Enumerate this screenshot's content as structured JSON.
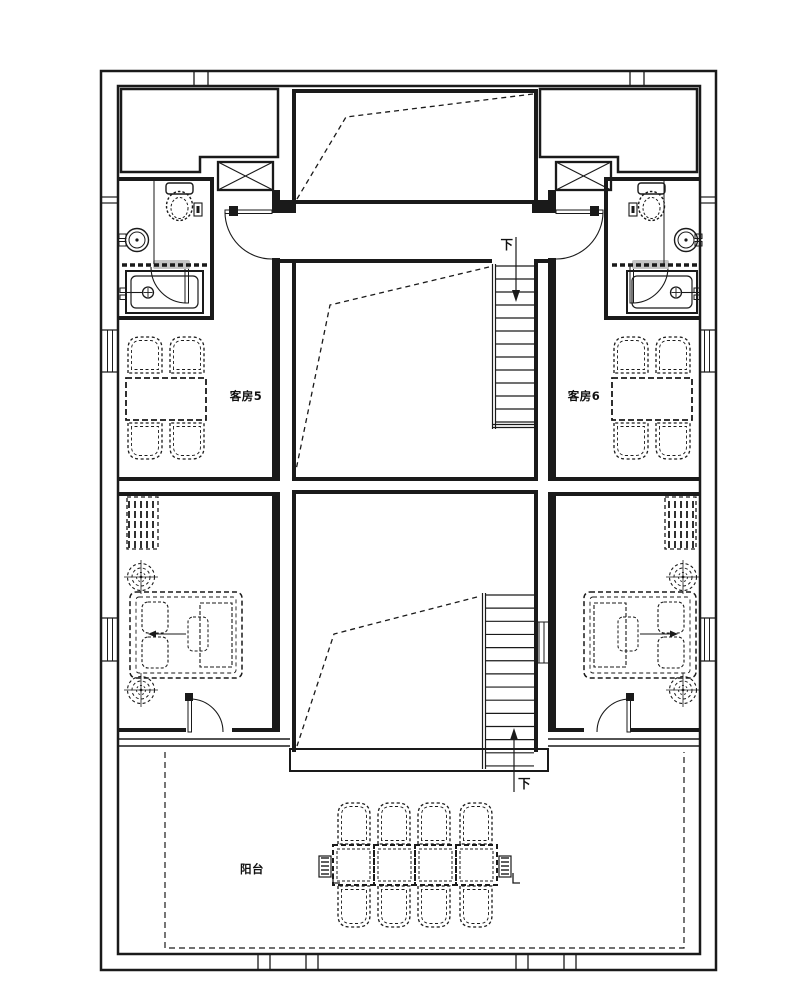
{
  "plan": {
    "labels": {
      "guest_room_5": "客房5",
      "guest_room_6": "客房6",
      "balcony": "阳台",
      "down": "下"
    },
    "rooms": [
      {
        "id": "guest-room-5",
        "label": "客房5",
        "furniture": [
          "table",
          "4 chairs"
        ]
      },
      {
        "id": "guest-room-6",
        "label": "客房6",
        "furniture": [
          "table",
          "4 chairs"
        ]
      },
      {
        "id": "bathroom-left",
        "fixtures": [
          "toilet",
          "washbasin",
          "bathtub"
        ]
      },
      {
        "id": "bathroom-right",
        "fixtures": [
          "toilet",
          "washbasin",
          "bathtub"
        ]
      },
      {
        "id": "bedroom-left",
        "furniture": [
          "double bed",
          "wardrobe",
          "2 round stools",
          "armchair"
        ]
      },
      {
        "id": "bedroom-right",
        "furniture": [
          "double bed",
          "wardrobe",
          "2 round stools",
          "armchair"
        ]
      },
      {
        "id": "balcony",
        "label": "阳台",
        "furniture": [
          "long dining table",
          "8 chairs",
          "2 planters"
        ]
      }
    ],
    "stairs": [
      {
        "id": "stair-upper",
        "label": "下",
        "direction": "down"
      },
      {
        "id": "stair-lower",
        "label": "下",
        "direction": "down"
      }
    ],
    "colors": {
      "line": "#1a1a1a",
      "background": "#ffffff",
      "threshold": "#c4c4c4"
    }
  }
}
